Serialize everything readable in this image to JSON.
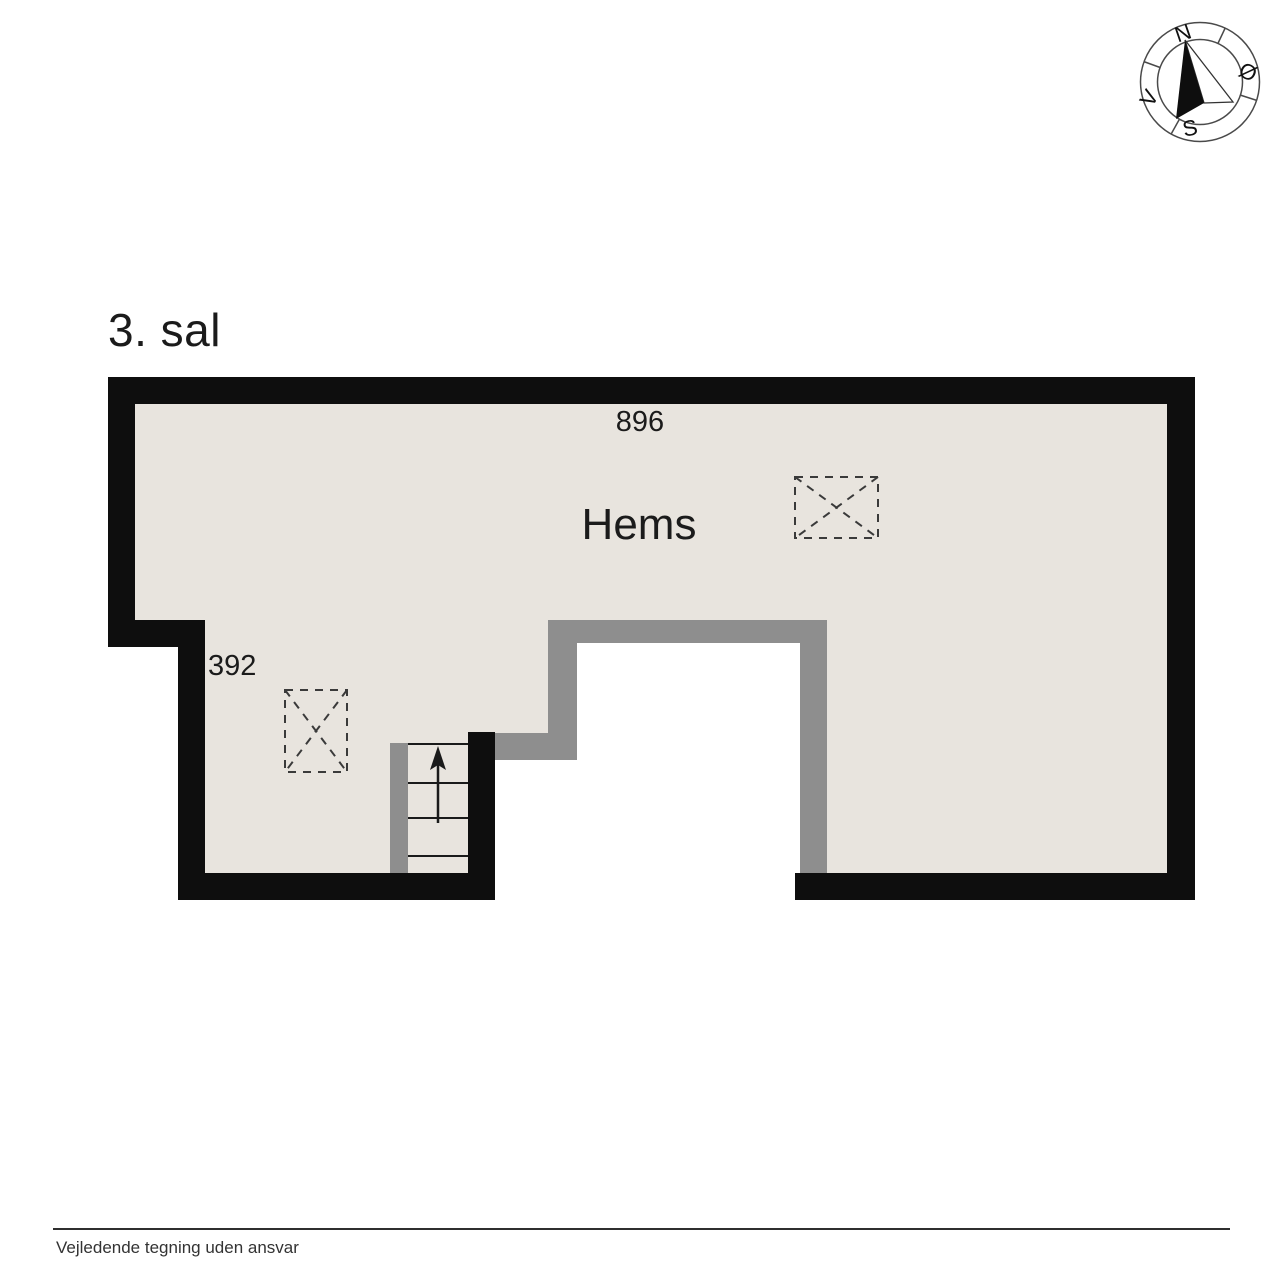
{
  "page": {
    "title": "3. sal",
    "footer": "Vejledende tegning uden ansvar"
  },
  "plan": {
    "room_label": "Hems",
    "dim_top": "896",
    "dim_left": "392"
  },
  "compass": {
    "n": "N",
    "e": "Ø",
    "s": "S",
    "w": "V"
  },
  "colors": {
    "wall": "#0e0e0e",
    "floor": "#e8e4de",
    "railing": "#8e8e8e",
    "void": "#ffffff",
    "text": "#1b1b1b"
  }
}
